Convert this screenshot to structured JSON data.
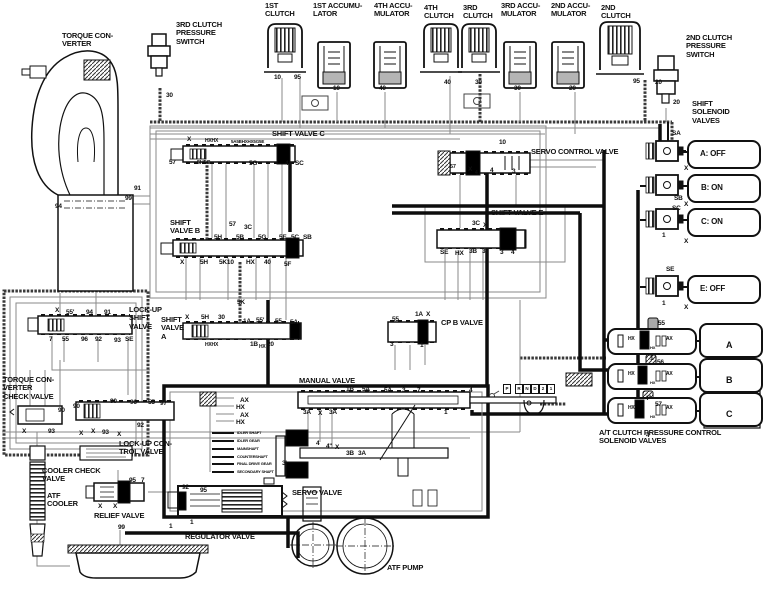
{
  "diagram_type": "automatic-transmission-hydraulic-circuit",
  "colors": {
    "line": "#111111",
    "thin_line": "#8a8a8a",
    "hatched_line": "#3a3a3a",
    "accumulator_fill": "#b5b5b5",
    "background": "#ffffff"
  },
  "solenoids": {
    "A": "OFF",
    "B": "ON",
    "C": "ON",
    "E": "OFF"
  },
  "gear_positions": [
    "P",
    "R",
    "N",
    "D",
    "2",
    "1"
  ],
  "labels": [
    {
      "n": "torque-converter-label",
      "t": "TORQUE CON-\nVERTER",
      "x": 62,
      "y": 32,
      "s": 7.5
    },
    {
      "n": "3rd-clutch-pressure-switch-label",
      "t": "3RD CLUTCH\nPRESSURE\nSWITCH",
      "x": 176,
      "y": 21,
      "s": 7.5
    },
    {
      "n": "1st-clutch-label",
      "t": "1ST\nCLUTCH",
      "x": 265,
      "y": 2,
      "s": 7.5
    },
    {
      "n": "1st-accumulator-label",
      "t": "1ST ACCUMU-\nLATOR",
      "x": 313,
      "y": 2,
      "s": 7.5
    },
    {
      "n": "4th-accumulator-label",
      "t": "4TH ACCU-\nMULATOR",
      "x": 374,
      "y": 2,
      "s": 7.5
    },
    {
      "n": "4th-clutch-label",
      "t": "4TH\nCLUTCH",
      "x": 424,
      "y": 4,
      "s": 7.5
    },
    {
      "n": "3rd-clutch-label",
      "t": "3RD\nCLUTCH",
      "x": 463,
      "y": 4,
      "s": 7.5
    },
    {
      "n": "3rd-accumulator-label",
      "t": "3RD ACCU-\nMULATOR",
      "x": 501,
      "y": 2,
      "s": 7.5
    },
    {
      "n": "2nd-accumulator-label",
      "t": "2ND ACCU-\nMULATOR",
      "x": 551,
      "y": 2,
      "s": 7.5
    },
    {
      "n": "2nd-clutch-label",
      "t": "2ND\nCLUTCH",
      "x": 601,
      "y": 4,
      "s": 7.5
    },
    {
      "n": "2nd-clutch-pressure-switch-label",
      "t": "2ND CLUTCH\nPRESSURE\nSWITCH",
      "x": 686,
      "y": 34,
      "s": 7.5
    },
    {
      "n": "shift-solenoid-valves-label",
      "t": "SHIFT\nSOLENOID\nVALVES",
      "x": 692,
      "y": 100,
      "s": 7.5
    },
    {
      "n": "shift-valve-c-label",
      "t": "SHIFT VALVE C",
      "x": 272,
      "y": 130,
      "s": 7.5
    },
    {
      "n": "servo-control-valve-label",
      "t": "SERVO CONTROL VALVE",
      "x": 531,
      "y": 148,
      "s": 7.5
    },
    {
      "n": "shift-valve-b-label",
      "t": "SHIFT\nVALVE B",
      "x": 170,
      "y": 219,
      "s": 7.5
    },
    {
      "n": "shift-valve-e-label",
      "t": "SHIFT VALVE E",
      "x": 491,
      "y": 209,
      "s": 7.5
    },
    {
      "n": "lock-up-shift-valve-label",
      "t": "LOCK-UP\nSHIFT\nVALVE",
      "x": 129,
      "y": 306,
      "s": 7.5
    },
    {
      "n": "shift-valve-a-label",
      "t": "SHIFT\nVALVE\nA",
      "x": 161,
      "y": 316,
      "s": 7.5
    },
    {
      "n": "cpb-valve-label",
      "t": "CP B VALVE",
      "x": 441,
      "y": 319,
      "s": 7.5
    },
    {
      "n": "manual-valve-label",
      "t": "MANUAL VALVE",
      "x": 299,
      "y": 377,
      "s": 7.5
    },
    {
      "n": "torque-converter-check-valve-label",
      "t": "TORQUE CON-\nVERTER\nCHECK VALVE",
      "x": 3,
      "y": 376,
      "s": 7.5
    },
    {
      "n": "lock-up-control-valve-label",
      "t": "LOCK-UP CON-\nTROL VALVE",
      "x": 119,
      "y": 440,
      "s": 7.5
    },
    {
      "n": "cooler-check-valve-label",
      "t": "COOLER CHECK\nVALVE",
      "x": 42,
      "y": 467,
      "s": 7.5
    },
    {
      "n": "atf-cooler-label",
      "t": "ATF\nCOOLER",
      "x": 47,
      "y": 492,
      "s": 7.5
    },
    {
      "n": "relief-valve-label",
      "t": "RELIEF VALVE",
      "x": 94,
      "y": 512,
      "s": 7.5
    },
    {
      "n": "regulator-valve-label",
      "t": "REGULATOR VALVE",
      "x": 185,
      "y": 533,
      "s": 7.5
    },
    {
      "n": "servo-valve-label",
      "t": "SERVO VALVE",
      "x": 292,
      "y": 489,
      "s": 7.5
    },
    {
      "n": "atf-pump-label",
      "t": "ATF PUMP",
      "x": 387,
      "y": 564,
      "s": 7.5
    },
    {
      "n": "at-cpc-solenoid-valves-label",
      "t": "A/T CLUTCH PRESSURE CONTROL\nSOLENOID VALVES",
      "x": 599,
      "y": 429,
      "s": 7.5
    },
    {
      "n": "solenoid-a-state",
      "t": "A: OFF",
      "x": 700,
      "y": 150,
      "s": 8
    },
    {
      "n": "solenoid-b-state",
      "t": "B: ON",
      "x": 701,
      "y": 184,
      "s": 8
    },
    {
      "n": "solenoid-c-state",
      "t": "C: ON",
      "x": 701,
      "y": 218,
      "s": 8
    },
    {
      "n": "solenoid-e-state",
      "t": "E: OFF",
      "x": 700,
      "y": 285,
      "s": 8
    },
    {
      "n": "cpc-a-letter",
      "t": "A",
      "x": 726,
      "y": 340,
      "s": 9
    },
    {
      "n": "cpc-b-letter",
      "t": "B",
      "x": 726,
      "y": 375,
      "s": 9
    },
    {
      "n": "cpc-c-letter",
      "t": "C",
      "x": 726,
      "y": 409,
      "s": 9
    },
    {
      "n": "port",
      "t": "30",
      "x": 166,
      "y": 92
    },
    {
      "n": "port",
      "t": "10",
      "x": 274,
      "y": 74
    },
    {
      "n": "port",
      "t": "95",
      "x": 294,
      "y": 74
    },
    {
      "n": "port",
      "t": "10",
      "x": 333,
      "y": 85
    },
    {
      "n": "port",
      "t": "40",
      "x": 379,
      "y": 85
    },
    {
      "n": "port",
      "t": "40",
      "x": 444,
      "y": 79
    },
    {
      "n": "port",
      "t": "30",
      "x": 475,
      "y": 79
    },
    {
      "n": "port",
      "t": "30",
      "x": 514,
      "y": 85
    },
    {
      "n": "port",
      "t": "20",
      "x": 569,
      "y": 85
    },
    {
      "n": "port",
      "t": "95",
      "x": 633,
      "y": 78
    },
    {
      "n": "port",
      "t": "20",
      "x": 655,
      "y": 79
    },
    {
      "n": "port",
      "t": "20",
      "x": 673,
      "y": 99
    },
    {
      "n": "port",
      "t": "91",
      "x": 134,
      "y": 185
    },
    {
      "n": "port",
      "t": "99",
      "x": 125,
      "y": 195
    },
    {
      "n": "port",
      "t": "94",
      "x": 55,
      "y": 203
    },
    {
      "n": "port",
      "t": "X",
      "x": 187,
      "y": 136
    },
    {
      "n": "port",
      "t": "HXHX",
      "x": 205,
      "y": 139,
      "s": 5
    },
    {
      "n": "port",
      "t": "5A5BHXHX5G5E",
      "x": 231,
      "y": 139,
      "s": 4.5
    },
    {
      "n": "port",
      "t": "57",
      "x": 169,
      "y": 159
    },
    {
      "n": "port",
      "t": "5H5C",
      "x": 197,
      "y": 160,
      "s": 5.5
    },
    {
      "n": "port",
      "t": "5G",
      "x": 249,
      "y": 160
    },
    {
      "n": "port",
      "t": "4",
      "x": 285,
      "y": 160
    },
    {
      "n": "port",
      "t": "SC",
      "x": 295,
      "y": 160
    },
    {
      "n": "port",
      "t": "10",
      "x": 499,
      "y": 139
    },
    {
      "n": "port",
      "t": "57",
      "x": 450,
      "y": 164,
      "s": 5.5
    },
    {
      "n": "port",
      "t": "X",
      "x": 468,
      "y": 166
    },
    {
      "n": "port",
      "t": "4",
      "x": 475,
      "y": 171,
      "s": 5
    },
    {
      "n": "port",
      "t": "4",
      "x": 490,
      "y": 167
    },
    {
      "n": "port",
      "t": "3",
      "x": 512,
      "y": 168
    },
    {
      "n": "port",
      "t": "SA",
      "x": 672,
      "y": 130
    },
    {
      "n": "port",
      "t": "X",
      "x": 684,
      "y": 165
    },
    {
      "n": "port",
      "t": "SB",
      "x": 674,
      "y": 195
    },
    {
      "n": "port",
      "t": "X",
      "x": 684,
      "y": 201
    },
    {
      "n": "port",
      "t": "SC",
      "x": 672,
      "y": 205
    },
    {
      "n": "port",
      "t": "1",
      "x": 662,
      "y": 232
    },
    {
      "n": "port",
      "t": "X",
      "x": 684,
      "y": 238
    },
    {
      "n": "port",
      "t": "SE",
      "x": 666,
      "y": 266
    },
    {
      "n": "port",
      "t": "1",
      "x": 662,
      "y": 300
    },
    {
      "n": "port",
      "t": "X",
      "x": 684,
      "y": 304
    },
    {
      "n": "port",
      "t": "57",
      "x": 229,
      "y": 221
    },
    {
      "n": "port",
      "t": "3C",
      "x": 244,
      "y": 224
    },
    {
      "n": "port",
      "t": "5H",
      "x": 214,
      "y": 234
    },
    {
      "n": "port",
      "t": "5B",
      "x": 236,
      "y": 234
    },
    {
      "n": "port",
      "t": "5G",
      "x": 258,
      "y": 234
    },
    {
      "n": "port",
      "t": "5E",
      "x": 279,
      "y": 234
    },
    {
      "n": "port",
      "t": "5C",
      "x": 291,
      "y": 234
    },
    {
      "n": "port",
      "t": "SB",
      "x": 303,
      "y": 234
    },
    {
      "n": "port",
      "t": "X",
      "x": 180,
      "y": 259
    },
    {
      "n": "port",
      "t": "5H",
      "x": 200,
      "y": 259
    },
    {
      "n": "port",
      "t": "5K10",
      "x": 219,
      "y": 259
    },
    {
      "n": "port",
      "t": "HX",
      "x": 246,
      "y": 259
    },
    {
      "n": "port",
      "t": "40",
      "x": 264,
      "y": 259
    },
    {
      "n": "port",
      "t": "5F",
      "x": 284,
      "y": 261
    },
    {
      "n": "port",
      "t": "3C",
      "x": 472,
      "y": 220
    },
    {
      "n": "port",
      "t": "X",
      "x": 483,
      "y": 222
    },
    {
      "n": "port",
      "t": "SE",
      "x": 440,
      "y": 249
    },
    {
      "n": "port",
      "t": "HX",
      "x": 455,
      "y": 250
    },
    {
      "n": "port",
      "t": "3B",
      "x": 469,
      "y": 248
    },
    {
      "n": "port",
      "t": "3'",
      "x": 482,
      "y": 248
    },
    {
      "n": "port",
      "t": "3",
      "x": 500,
      "y": 249
    },
    {
      "n": "port",
      "t": "4",
      "x": 511,
      "y": 249
    },
    {
      "n": "port",
      "t": "5K",
      "x": 237,
      "y": 299
    },
    {
      "n": "port",
      "t": "X",
      "x": 55,
      "y": 307
    },
    {
      "n": "port",
      "t": "55'",
      "x": 66,
      "y": 309
    },
    {
      "n": "port",
      "t": "94",
      "x": 86,
      "y": 309
    },
    {
      "n": "port",
      "t": "91",
      "x": 104,
      "y": 309
    },
    {
      "n": "port",
      "t": "7",
      "x": 49,
      "y": 336
    },
    {
      "n": "port",
      "t": "55",
      "x": 62,
      "y": 336
    },
    {
      "n": "port",
      "t": "96",
      "x": 81,
      "y": 336
    },
    {
      "n": "port",
      "t": "92",
      "x": 95,
      "y": 336
    },
    {
      "n": "port",
      "t": "93",
      "x": 114,
      "y": 337
    },
    {
      "n": "port",
      "t": "SE",
      "x": 125,
      "y": 336
    },
    {
      "n": "port",
      "t": "X",
      "x": 185,
      "y": 314
    },
    {
      "n": "port",
      "t": "5H",
      "x": 201,
      "y": 314
    },
    {
      "n": "port",
      "t": "30",
      "x": 218,
      "y": 314
    },
    {
      "n": "port",
      "t": "1A",
      "x": 243,
      "y": 318
    },
    {
      "n": "port",
      "t": "55'",
      "x": 256,
      "y": 317
    },
    {
      "n": "port",
      "t": "55",
      "x": 275,
      "y": 318
    },
    {
      "n": "port",
      "t": "5A",
      "x": 290,
      "y": 319
    },
    {
      "n": "port",
      "t": "HXHX",
      "x": 205,
      "y": 343,
      "s": 5
    },
    {
      "n": "port",
      "t": "1B",
      "x": 250,
      "y": 341
    },
    {
      "n": "port",
      "t": "HX",
      "x": 259,
      "y": 345,
      "s": 5
    },
    {
      "n": "port",
      "t": "20",
      "x": 267,
      "y": 341
    },
    {
      "n": "port",
      "t": "55",
      "x": 392,
      "y": 316
    },
    {
      "n": "port",
      "t": "1A",
      "x": 415,
      "y": 311
    },
    {
      "n": "port",
      "t": "X",
      "x": 426,
      "y": 311
    },
    {
      "n": "port",
      "t": "3",
      "x": 390,
      "y": 341
    },
    {
      "n": "port",
      "t": "1",
      "x": 420,
      "y": 342
    },
    {
      "n": "port",
      "t": "1B",
      "x": 346,
      "y": 386
    },
    {
      "n": "port",
      "t": "5A",
      "x": 362,
      "y": 386
    },
    {
      "n": "port",
      "t": "5A",
      "x": 384,
      "y": 387
    },
    {
      "n": "port",
      "t": "3",
      "x": 402,
      "y": 387
    },
    {
      "n": "port",
      "t": "7",
      "x": 417,
      "y": 387
    },
    {
      "n": "port",
      "t": "4",
      "x": 469,
      "y": 387
    },
    {
      "n": "port",
      "t": "1",
      "x": 444,
      "y": 409
    },
    {
      "n": "port",
      "t": "3A",
      "x": 303,
      "y": 409
    },
    {
      "n": "port",
      "t": "X",
      "x": 318,
      "y": 410
    },
    {
      "n": "port",
      "t": "3A",
      "x": 329,
      "y": 409
    },
    {
      "n": "port",
      "t": "4",
      "x": 316,
      "y": 440
    },
    {
      "n": "port",
      "t": "4''",
      "x": 326,
      "y": 443
    },
    {
      "n": "port",
      "t": "X",
      "x": 335,
      "y": 444
    },
    {
      "n": "port",
      "t": "3B",
      "x": 346,
      "y": 450
    },
    {
      "n": "port",
      "t": "3A",
      "x": 358,
      "y": 450
    },
    {
      "n": "port",
      "t": "3'",
      "x": 282,
      "y": 460
    },
    {
      "n": "port",
      "t": "90",
      "x": 73,
      "y": 403
    },
    {
      "n": "port",
      "t": "90",
      "x": 110,
      "y": 398
    },
    {
      "n": "port",
      "t": "96",
      "x": 130,
      "y": 399
    },
    {
      "n": "port",
      "t": "55",
      "x": 148,
      "y": 399
    },
    {
      "n": "port",
      "t": "97",
      "x": 160,
      "y": 400
    },
    {
      "n": "port",
      "t": "X",
      "x": 79,
      "y": 430
    },
    {
      "n": "port",
      "t": "X",
      "x": 91,
      "y": 428
    },
    {
      "n": "port",
      "t": "93",
      "x": 102,
      "y": 429
    },
    {
      "n": "port",
      "t": "X",
      "x": 117,
      "y": 431
    },
    {
      "n": "port",
      "t": "92",
      "x": 137,
      "y": 422
    },
    {
      "n": "port",
      "t": "90",
      "x": 58,
      "y": 407
    },
    {
      "n": "port",
      "t": "X",
      "x": 22,
      "y": 428
    },
    {
      "n": "port",
      "t": "93",
      "x": 48,
      "y": 428
    },
    {
      "n": "port",
      "t": "95",
      "x": 129,
      "y": 477
    },
    {
      "n": "port",
      "t": "7",
      "x": 141,
      "y": 477
    },
    {
      "n": "port",
      "t": "X",
      "x": 98,
      "y": 503
    },
    {
      "n": "port",
      "t": "X",
      "x": 113,
      "y": 503
    },
    {
      "n": "port",
      "t": "92",
      "x": 182,
      "y": 484
    },
    {
      "n": "port",
      "t": "95",
      "x": 200,
      "y": 487
    },
    {
      "n": "port",
      "t": "1",
      "x": 169,
      "y": 523
    },
    {
      "n": "port",
      "t": "1",
      "x": 190,
      "y": 519
    },
    {
      "n": "port",
      "t": "99",
      "x": 118,
      "y": 524
    },
    {
      "n": "port",
      "t": "55",
      "x": 658,
      "y": 320
    },
    {
      "n": "port",
      "t": "1",
      "x": 650,
      "y": 355
    },
    {
      "n": "port",
      "t": "56",
      "x": 657,
      "y": 359
    },
    {
      "n": "port",
      "t": "4''",
      "x": 645,
      "y": 395
    },
    {
      "n": "port",
      "t": "57",
      "x": 655,
      "y": 401
    },
    {
      "n": "port",
      "t": "4",
      "x": 646,
      "y": 432
    },
    {
      "n": "port",
      "t": "HX",
      "x": 628,
      "y": 337,
      "s": 5
    },
    {
      "n": "port",
      "t": "AX",
      "x": 666,
      "y": 337,
      "s": 5
    },
    {
      "n": "port",
      "t": "HX",
      "x": 650,
      "y": 346,
      "s": 4
    },
    {
      "n": "port",
      "t": "HX",
      "x": 628,
      "y": 372,
      "s": 5
    },
    {
      "n": "port",
      "t": "AX",
      "x": 666,
      "y": 372,
      "s": 5
    },
    {
      "n": "port",
      "t": "HX",
      "x": 650,
      "y": 381,
      "s": 4
    },
    {
      "n": "port",
      "t": "HX",
      "x": 628,
      "y": 406,
      "s": 5
    },
    {
      "n": "port",
      "t": "AX",
      "x": 666,
      "y": 406,
      "s": 5
    },
    {
      "n": "port",
      "t": "HX",
      "x": 650,
      "y": 415,
      "s": 4
    },
    {
      "n": "lube-ax-1",
      "t": "AX",
      "x": 240,
      "y": 397,
      "s": 6.5
    },
    {
      "n": "lube-hx-1",
      "t": "HX",
      "x": 236,
      "y": 404,
      "s": 6.5
    },
    {
      "n": "lube-ax-2",
      "t": "AX",
      "x": 240,
      "y": 412,
      "s": 6.5
    },
    {
      "n": "lube-hx-2",
      "t": "HX",
      "x": 236,
      "y": 419,
      "s": 6.5
    },
    {
      "n": "lube-item",
      "t": "IDLER SHAFT",
      "x": 237,
      "y": 431,
      "s": 4
    },
    {
      "n": "lube-item",
      "t": "IDLER GEAR",
      "x": 237,
      "y": 439,
      "s": 4
    },
    {
      "n": "lube-item",
      "t": "MAINSHAFT",
      "x": 237,
      "y": 447,
      "s": 4
    },
    {
      "n": "lube-item",
      "t": "COUNTERSHAFT",
      "x": 237,
      "y": 455,
      "s": 4
    },
    {
      "n": "lube-item",
      "t": "FINAL DRIVE GEAR",
      "x": 237,
      "y": 462,
      "s": 4
    },
    {
      "n": "lube-item",
      "t": "SECONDARY SHAFT",
      "x": 237,
      "y": 470,
      "s": 4
    }
  ],
  "gear_box_origin": {
    "x": 503,
    "y": 384,
    "step": 8
  }
}
